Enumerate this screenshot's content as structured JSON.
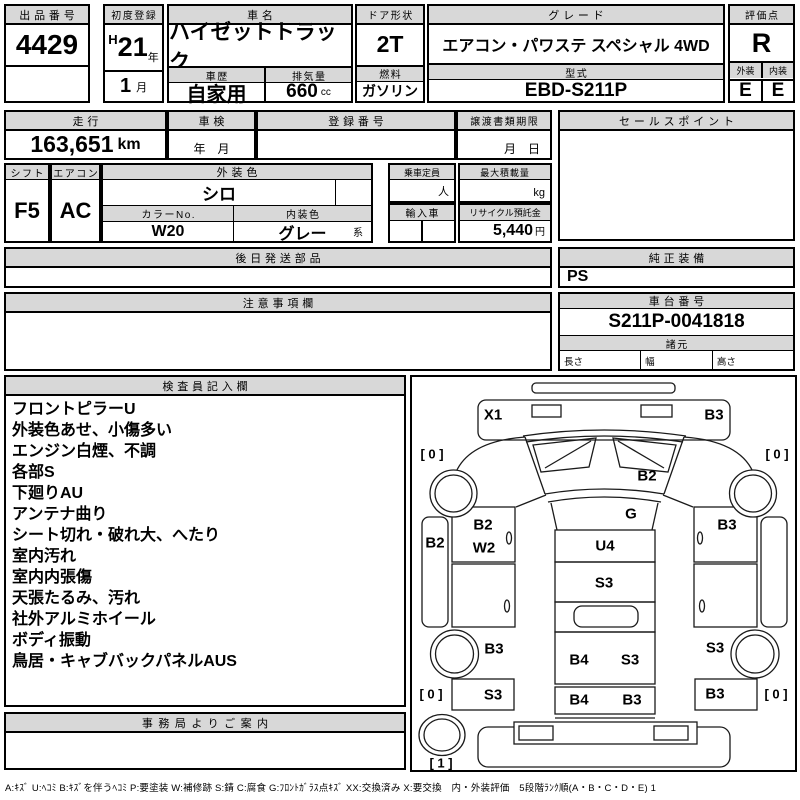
{
  "colors": {
    "header_bg": "#d8d8d8",
    "line": "#000000",
    "paper": "#ffffff"
  },
  "top": {
    "lot": {
      "label": "出品番号",
      "value": "4429"
    },
    "first_reg": {
      "label": "初度登録",
      "era": "H",
      "year": "21",
      "year_unit": "年",
      "month": "1",
      "month_unit": "月"
    },
    "car_name": {
      "label": "車名",
      "value": "ハイゼットトラック"
    },
    "history": {
      "label": "車歴",
      "value": "自家用"
    },
    "displacement": {
      "label": "排気量",
      "value": "660",
      "unit": "cc"
    },
    "door": {
      "label": "ドア形状",
      "value": "2T"
    },
    "fuel": {
      "label": "燃料",
      "value": "ガソリン"
    },
    "grade": {
      "label": "グレード",
      "value": "エアコン・パワステ スペシャル 4WD"
    },
    "model": {
      "label": "型式",
      "value": "EBD-S211P"
    },
    "score": {
      "label": "評価点",
      "value": "R"
    },
    "exterior": {
      "label": "外装",
      "value": "E"
    },
    "interior": {
      "label": "内装",
      "value": "E"
    }
  },
  "mileage": {
    "label": "走行",
    "value": "163,651",
    "unit": "km"
  },
  "shaken": {
    "label": "車検",
    "value": "年　月"
  },
  "reg_no": {
    "label": "登録番号",
    "value": ""
  },
  "transfer": {
    "label": "譲渡書類期限",
    "value": "月　日"
  },
  "sales_point": {
    "label": "セールスポイント",
    "value": ""
  },
  "shift": {
    "label": "シフト",
    "value": "F5"
  },
  "aircon": {
    "label": "エアコン",
    "value": "AC"
  },
  "ext_color": {
    "label": "外装色",
    "value": "シロ"
  },
  "capacity": {
    "label": "乗車定員",
    "unit": "人"
  },
  "max_load": {
    "label": "最大積載量",
    "unit": "kg"
  },
  "color_no": {
    "label": "カラーNo.",
    "value": "W20"
  },
  "int_color": {
    "label": "内装色",
    "value": "グレー",
    "suffix": "系"
  },
  "import_car": {
    "label": "輸入車"
  },
  "recycle": {
    "label": "リサイクル預託金",
    "value": "5,440",
    "unit": "円"
  },
  "later_parts": {
    "label": "後日発送部品",
    "value": ""
  },
  "oem_equip": {
    "label": "純正装備",
    "value": "PS"
  },
  "notice": {
    "label": "注意事項欄",
    "value": ""
  },
  "chassis": {
    "label": "車台番号",
    "value": "S211P-0041818"
  },
  "specs": {
    "label": "諸元",
    "length_label": "長さ",
    "width_label": "幅",
    "height_label": "高さ"
  },
  "inspection": {
    "label": "検査員記入欄",
    "notes": [
      "フロントピラーU",
      "外装色あせ、小傷多い",
      "エンジン白煙、不調",
      "各部S",
      "下廻りAU",
      "アンテナ曲り",
      "シート切れ・破れ大、へたり",
      "室内汚れ",
      "室内内張傷",
      "天張たるみ、汚れ",
      "社外アルミホイール",
      "ボディ振動",
      "鳥居・キャブバックパネルAUS"
    ]
  },
  "office": {
    "label": "事務局よりご案内",
    "value": ""
  },
  "legend": "A:ｷｽﾞ U:ﾍｺﾐ B:ｷｽﾞを伴うﾍｺﾐ P:要塗装 W:補修跡 S:錆 C:腐食 G:ﾌﾛﾝﾄｶﾞﾗｽ点ｷｽﾞ XX:交換済み X:要交換　内・外装評価　5段階ﾗﾝｸ順(A・B・C・D・E) 1",
  "diagram": {
    "marks": {
      "front_left": "X1",
      "front_right": "B3",
      "windshield": "B2",
      "roof": "G",
      "tire_front_left": "[ 0 ]",
      "tire_front_right": "[ 0 ]",
      "sill_left": "B2",
      "door_left_a": "B2",
      "door_left_b": "W2",
      "door_right": "B3",
      "cab_floor": "U4",
      "bed_front": "S3",
      "rear_left": "B3",
      "rear_right": "S3",
      "side_left_lower": "S3",
      "side_right_lower": "B3",
      "bed_mid_a": "B4",
      "bed_mid_b": "S3",
      "tailgate_a": "B4",
      "tailgate_b": "B3",
      "tire_rear_left": "[ 0 ]",
      "tire_rear_right": "[ 0 ]",
      "spare": "[ 1 ]"
    }
  }
}
